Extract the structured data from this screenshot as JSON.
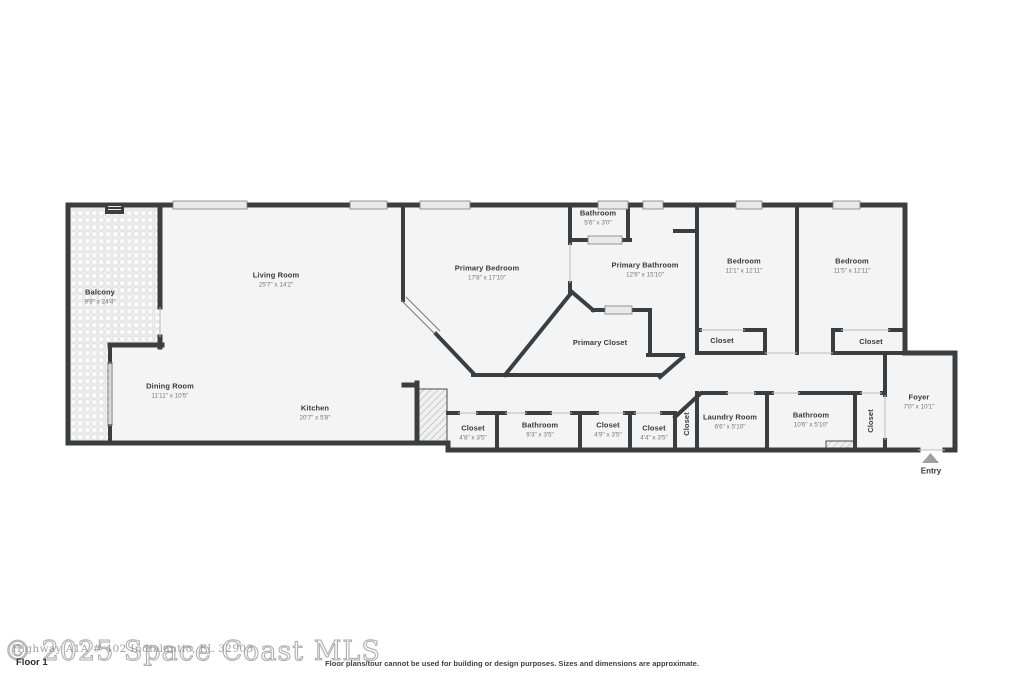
{
  "floorplan": {
    "floor_label": "Floor 1",
    "disclaimer": "Floor plans/tour cannot be used for building or design purposes. Sizes and dimensions are approximate.",
    "watermark": {
      "main": "© 2025 Space Coast MLS",
      "secondary": "Highway A1A # 402 Indialantic, FL 32903"
    },
    "entry": {
      "label": "Entry"
    },
    "rooms": [
      {
        "id": "balcony",
        "name": "Balcony",
        "dims": "9'9\" x 24'4\"",
        "x": 100,
        "y": 297
      },
      {
        "id": "living-room",
        "name": "Living Room",
        "dims": "25'7\" x 14'2\"",
        "x": 276,
        "y": 280
      },
      {
        "id": "primary-bedroom",
        "name": "Primary Bedroom",
        "dims": "17'8\" x 17'10\"",
        "x": 487,
        "y": 273
      },
      {
        "id": "bathroom-upper",
        "name": "Bathroom",
        "dims": "5'6\" x 3'0\"",
        "x": 598,
        "y": 218
      },
      {
        "id": "primary-bathroom",
        "name": "Primary Bathroom",
        "dims": "12'9\" x 15'10\"",
        "x": 645,
        "y": 270
      },
      {
        "id": "bedroom-left",
        "name": "Bedroom",
        "dims": "11'1\" x 12'11\"",
        "x": 744,
        "y": 266
      },
      {
        "id": "bedroom-right",
        "name": "Bedroom",
        "dims": "11'5\" x 12'11\"",
        "x": 852,
        "y": 266
      },
      {
        "id": "closet-bed-left",
        "name": "Closet",
        "dims": "",
        "x": 722,
        "y": 341
      },
      {
        "id": "closet-bed-right",
        "name": "Closet",
        "dims": "",
        "x": 871,
        "y": 342
      },
      {
        "id": "primary-closet",
        "name": "Primary Closet",
        "dims": "",
        "x": 600,
        "y": 343
      },
      {
        "id": "dining-room",
        "name": "Dining Room",
        "dims": "11'11\" x 10'5\"",
        "x": 170,
        "y": 391
      },
      {
        "id": "kitchen",
        "name": "Kitchen",
        "dims": "20'7\" x 5'8\"",
        "x": 315,
        "y": 413
      },
      {
        "id": "closet-hall-a",
        "name": "Closet",
        "dims": "4'8\" x 3'5\"",
        "x": 473,
        "y": 433
      },
      {
        "id": "bathroom-hall",
        "name": "Bathroom",
        "dims": "9'3\" x 3'5\"",
        "x": 540,
        "y": 430
      },
      {
        "id": "closet-hall-b",
        "name": "Closet",
        "dims": "4'9\" x 3'5\"",
        "x": 608,
        "y": 430
      },
      {
        "id": "closet-hall-c",
        "name": "Closet",
        "dims": "4'4\" x 3'5\"",
        "x": 654,
        "y": 433
      },
      {
        "id": "closet-vert-a",
        "name": "Closet",
        "dims": "",
        "x": 687,
        "y": 424,
        "rotate": true
      },
      {
        "id": "laundry-room",
        "name": "Laundry Room",
        "dims": "6'6\" x 5'10\"",
        "x": 730,
        "y": 422
      },
      {
        "id": "bathroom-lower",
        "name": "Bathroom",
        "dims": "10'6\" x 5'10\"",
        "x": 811,
        "y": 420
      },
      {
        "id": "closet-vert-b",
        "name": "Closet",
        "dims": "",
        "x": 871,
        "y": 421,
        "rotate": true
      },
      {
        "id": "foyer",
        "name": "Foyer",
        "dims": "7'0\" x 10'1\"",
        "x": 919,
        "y": 402
      }
    ]
  },
  "colors": {
    "wall": "#3b3e40",
    "floor": "#f4f4f4",
    "window_fill": "#e9e9e9",
    "window_edge": "#7e7e7e",
    "door_sill": "#bdbdbd",
    "entry_arrow": "#a0a0a0"
  }
}
